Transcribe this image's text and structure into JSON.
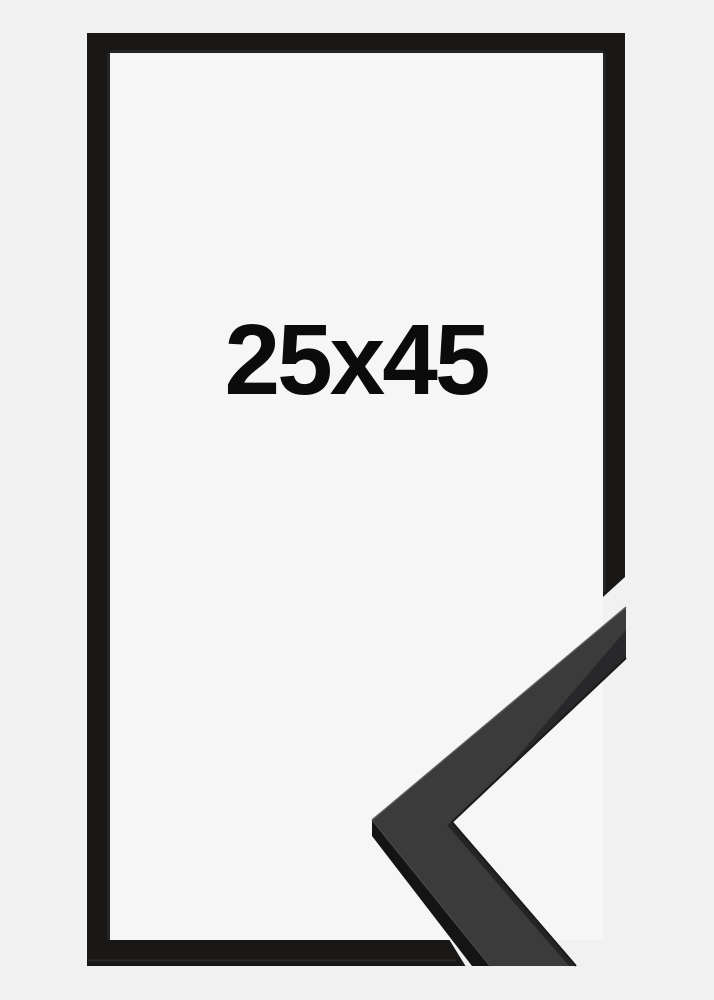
{
  "product": {
    "size_label": "25x45",
    "frame_style": "black"
  },
  "colors": {
    "background": "#f1f1f2",
    "interior": "#f6f6f7",
    "frame_outline": "#191817",
    "frame_lip": "#3b3b3b",
    "sample_side": "#141414",
    "sample_face": "#3b3b3c",
    "sample_shade_upper": "#28282a",
    "sample_shade_lower": "#242427",
    "sample_edge_dark": "#1a1a1b",
    "sample_highlight_top": "#55555a",
    "sample_highlight_arris": "#4a4a4d",
    "label_text": "#0b0b0b"
  }
}
